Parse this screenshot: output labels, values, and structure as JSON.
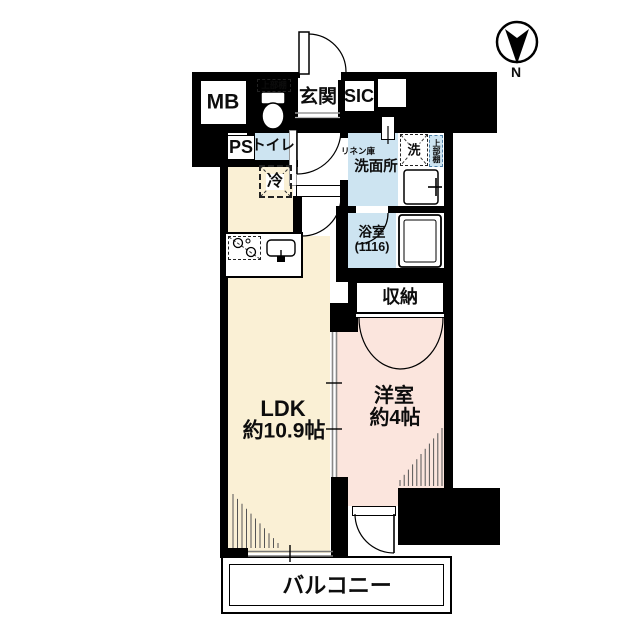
{
  "plan": {
    "compass_label": "N",
    "labels": {
      "mb": "MB",
      "ps": "PS",
      "toilet": "トイレ",
      "toilet_shelf": "上部棚",
      "genkan": "玄関",
      "sic": "SIC",
      "linen": "リネン庫",
      "senmenjo": "洗面所",
      "washer": "洗",
      "washer_shelf": "上部棚",
      "bath_line1": "浴室",
      "bath_line2": "(1116)",
      "closet": "収納",
      "bedroom_line1": "洋室",
      "bedroom_line2": "約4帖",
      "ldk_line1": "LDK",
      "ldk_line2": "約10.9帖",
      "balcony": "バルコニー",
      "fridge": "冷"
    },
    "colors": {
      "wall": "#000000",
      "wet_area": "#cde4f1",
      "ldk": "#faf0d5",
      "bedroom": "#fbe5dd",
      "line_gray": "#8a8a8a"
    }
  }
}
